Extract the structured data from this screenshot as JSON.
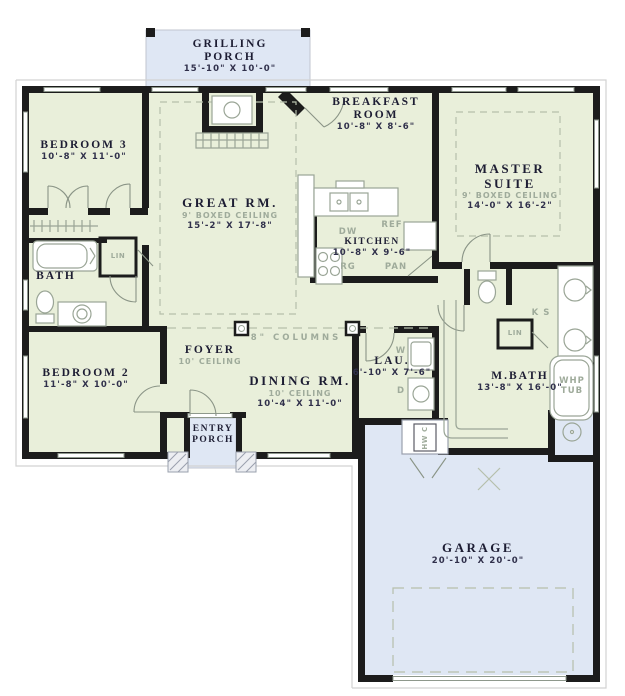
{
  "title": "House floor plan",
  "colors": {
    "room_fill": "#e9efda",
    "porch_fill": "#dfe7f4",
    "wall": "#1c1c1c",
    "room_label": "#1d1d33",
    "dimension_text": "#30304b",
    "muted_label": "#9fab9b",
    "fixture_line": "#9aa596"
  },
  "rooms": {
    "grilling_porch": {
      "line1": "GRILLING",
      "line2": "PORCH",
      "dims": "15'-10\" X 10'-0\""
    },
    "breakfast": {
      "line1": "BREAKFAST",
      "line2": "ROOM",
      "dims": "10'-8\" X 8'-6\""
    },
    "bedroom3": {
      "line1": "BEDROOM 3",
      "dims": "10'-8\" X 11'-0\""
    },
    "great": {
      "line1": "GREAT RM.",
      "ceiling": "9' BOXED CEILING",
      "dims": "15'-2\" X 17'-8\""
    },
    "master": {
      "line1": "MASTER",
      "line2": "SUITE",
      "ceiling": "9' BOXED CEILING",
      "dims": "14'-0\" X 16'-2\""
    },
    "kitchen": {
      "line1": "KITCHEN",
      "dims": "10'-8\" X 9'-6\""
    },
    "bath": {
      "line1": "BATH"
    },
    "bedroom2": {
      "line1": "BEDROOM 2",
      "dims": "11'-8\" X 10'-0\""
    },
    "foyer": {
      "line1": "FOYER",
      "ceiling": "10' CEILING"
    },
    "dining": {
      "line1": "DINING RM.",
      "ceiling": "10' CEILING",
      "dims": "10'-4\" X 11'-0\""
    },
    "laundry": {
      "line1": "LAU.",
      "dims": "6'-10\" X 7'-6\""
    },
    "mbath": {
      "line1": "M.BATH",
      "dims": "13'-8\" X 16'-0\""
    },
    "entry_porch": {
      "line1": "ENTRY",
      "line2": "PORCH"
    },
    "garage": {
      "line1": "GARAGE",
      "dims": "20'-10\" X 20'-0\""
    }
  },
  "annotations": {
    "columns": "8\" COLUMNS",
    "dishwasher": "DW",
    "refrigerator": "REF",
    "range": "RG",
    "pantry": "PAN",
    "washer": "W",
    "dryer": "D",
    "linen_bath": "LIN",
    "linen_mbath": "LIN",
    "knee_space": "K S",
    "whirlpool_line1": "WHP",
    "whirlpool_line2": "TUB",
    "water_heater": "HW C"
  }
}
